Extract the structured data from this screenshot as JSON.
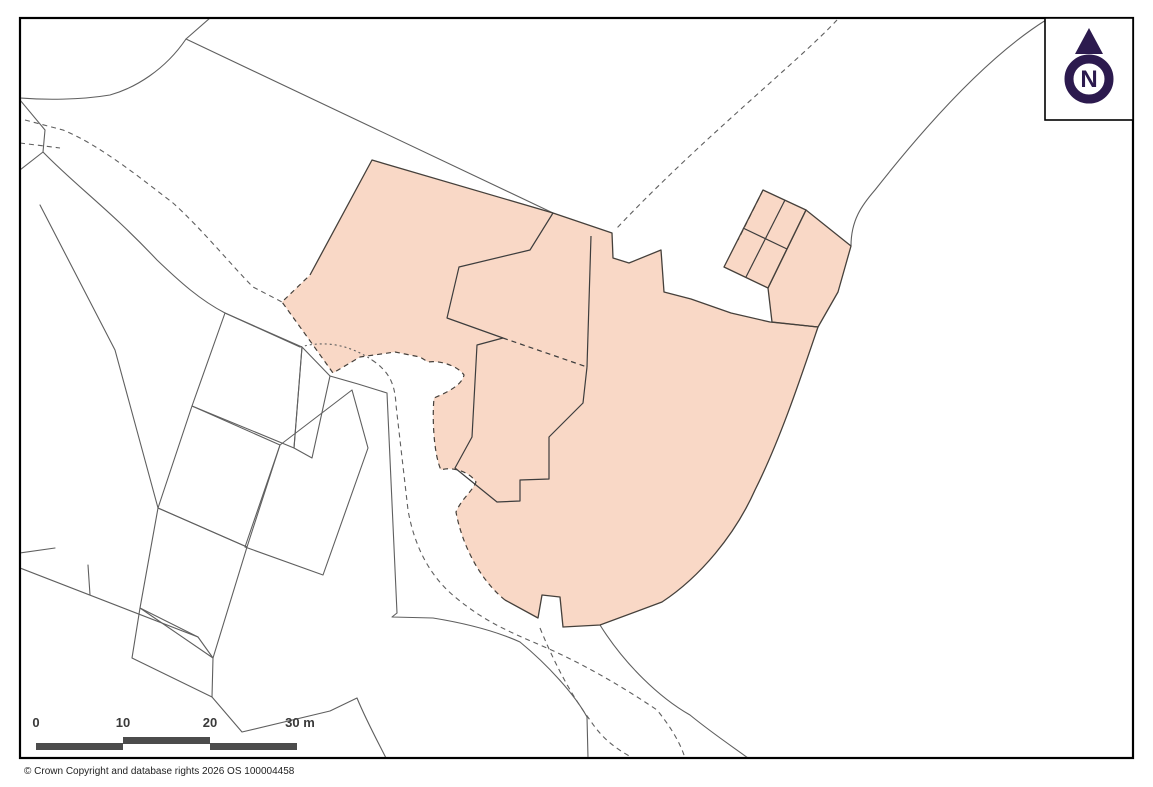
{
  "attribution": {
    "text": "© Crown Copyright and database rights 2026 OS 100004458"
  },
  "compass": {
    "label": "N"
  },
  "scale_bar": {
    "labels": [
      "0",
      "10",
      "20",
      "30 m"
    ]
  },
  "colors": {
    "highlight": "#f9d8c6",
    "boundary": "#45403b",
    "building-line": "#3d3d3d",
    "map-line": "#5f5f5f",
    "scalebar": "#4c4c4c",
    "compass": "#2c1a4e",
    "frame": "#000000"
  }
}
